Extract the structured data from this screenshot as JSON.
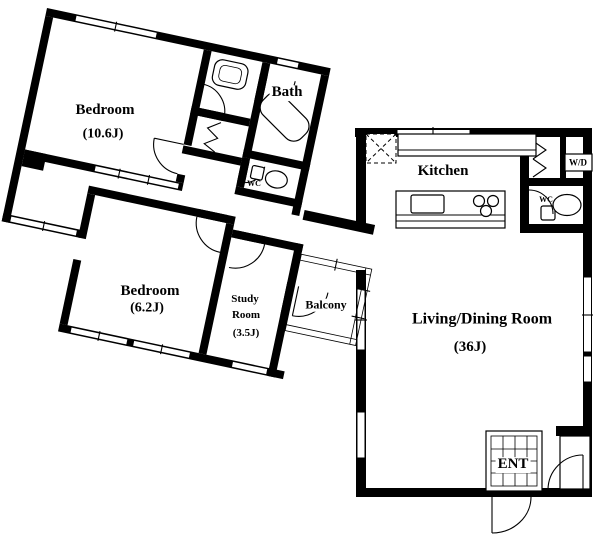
{
  "rooms": {
    "bedroom_large": {
      "name": "Bedroom",
      "area": "(10.6J)"
    },
    "bedroom_small": {
      "name": "Bedroom",
      "area": "(6.2J)"
    },
    "study": {
      "name_line1": "Study",
      "name_line2": "Room",
      "area": "(3.5J)"
    },
    "bath": {
      "name": "Bath"
    },
    "balcony": {
      "name": "Balcony"
    },
    "kitchen": {
      "name": "Kitchen"
    },
    "living_dining": {
      "name": "Living/Dining Room",
      "area": "(36J)"
    },
    "entrance": {
      "name": "ENT"
    },
    "wc_bath_side": {
      "name": "WC"
    },
    "wc_kitchen_side": {
      "name": "WC"
    },
    "washer_dryer": {
      "name": "W/D"
    }
  },
  "colors": {
    "wall": "#000000",
    "floor": "#ffffff"
  }
}
